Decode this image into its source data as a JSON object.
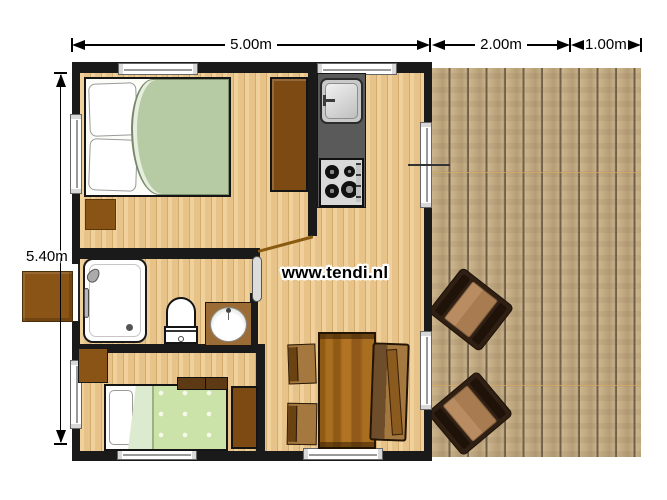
{
  "watermark": {
    "text": "www.tendi.nl"
  },
  "dimensions": {
    "top": [
      {
        "label": "5.00m"
      },
      {
        "label": "2.00m"
      },
      {
        "label": "1.00m"
      }
    ],
    "side": {
      "label": "5.40m"
    }
  },
  "colors": {
    "wall": "#1a1a1a",
    "interior_floor": "#e7c38a",
    "floor_plank_line": "#d2ab6f",
    "deck_wood": "#c3ab84",
    "deck_plank_line": "#6f6049",
    "furniture_brown": "#7c4a12",
    "table_wood": "#9a6018",
    "duvet_double": "#b6caa3",
    "duvet_single": "#cbe2a9",
    "counter_gray": "#5a5a5a",
    "fixture_white": "#ffffff",
    "dimension_ink": "#000000"
  }
}
